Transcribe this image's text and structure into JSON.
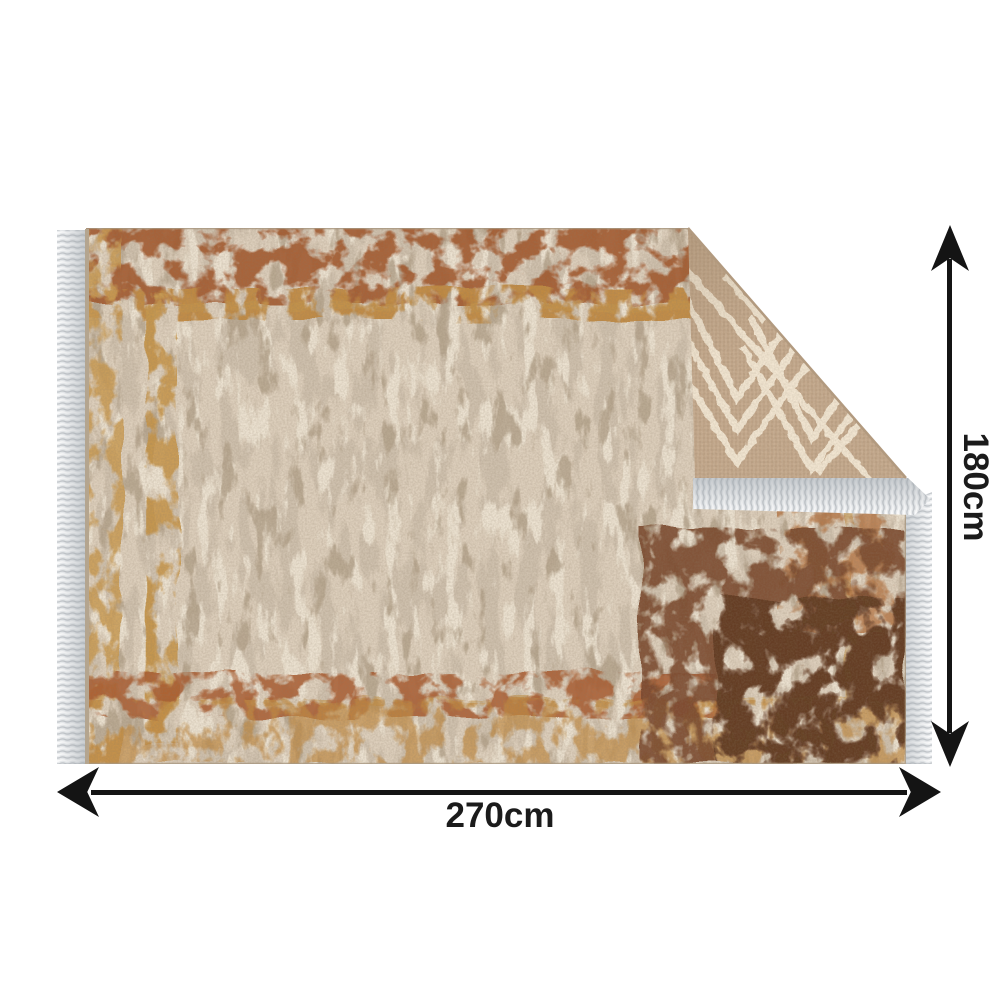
{
  "page": {
    "background_color": "#ffffff"
  },
  "figure": {
    "type": "product-dimension-image",
    "subject": "Vintage distressed beige-brown rug with fringed ends; top-right corner folded over showing reverse side with cream chevron pattern",
    "rug_colors": {
      "field_base": "#cfc1ae",
      "field_light": "#ece2d1",
      "field_shadow": "#b5a48d",
      "border_rust": "#a2582e",
      "border_gold": "#c99a52",
      "corner_dark_brown": "#6a422a",
      "fold_back_base": "#c3a88c",
      "fold_back_lines": "#f1e5d1",
      "fringe": "#eceef0"
    }
  },
  "dimensions": {
    "width": {
      "label": "270cm",
      "value": 270,
      "unit": "cm"
    },
    "height": {
      "label": "180cm",
      "value": 180,
      "unit": "cm"
    },
    "arrow_color": "#141414",
    "label_color": "#1b1b1b",
    "width_arrow_icon": "double-headed-horizontal-arrow-icon",
    "height_arrow_icon": "double-headed-vertical-arrow-icon"
  }
}
